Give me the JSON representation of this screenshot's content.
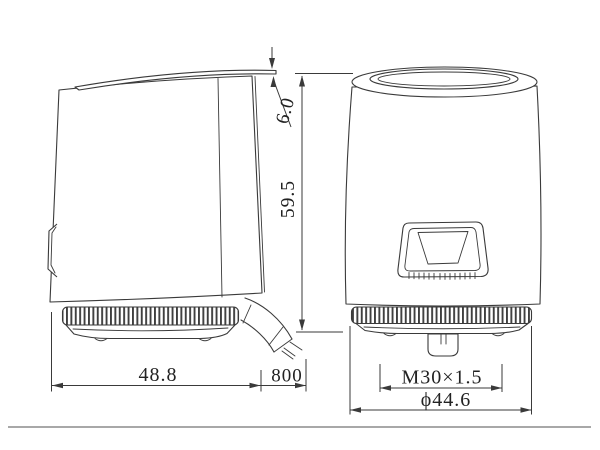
{
  "drawing_type": "actuator-two-view-dimension-drawing",
  "dimensions": {
    "cap_height": "6.0",
    "total_height": "59.5",
    "body_width": "48.8",
    "cable_length": "800",
    "thread_spec": "M30×1.5",
    "knurl_diameter": "ϕ44.6"
  },
  "colors": {
    "line": "#3a3a3a",
    "text": "#222222",
    "page_border": "#9b9b9b",
    "background": "#ffffff"
  }
}
